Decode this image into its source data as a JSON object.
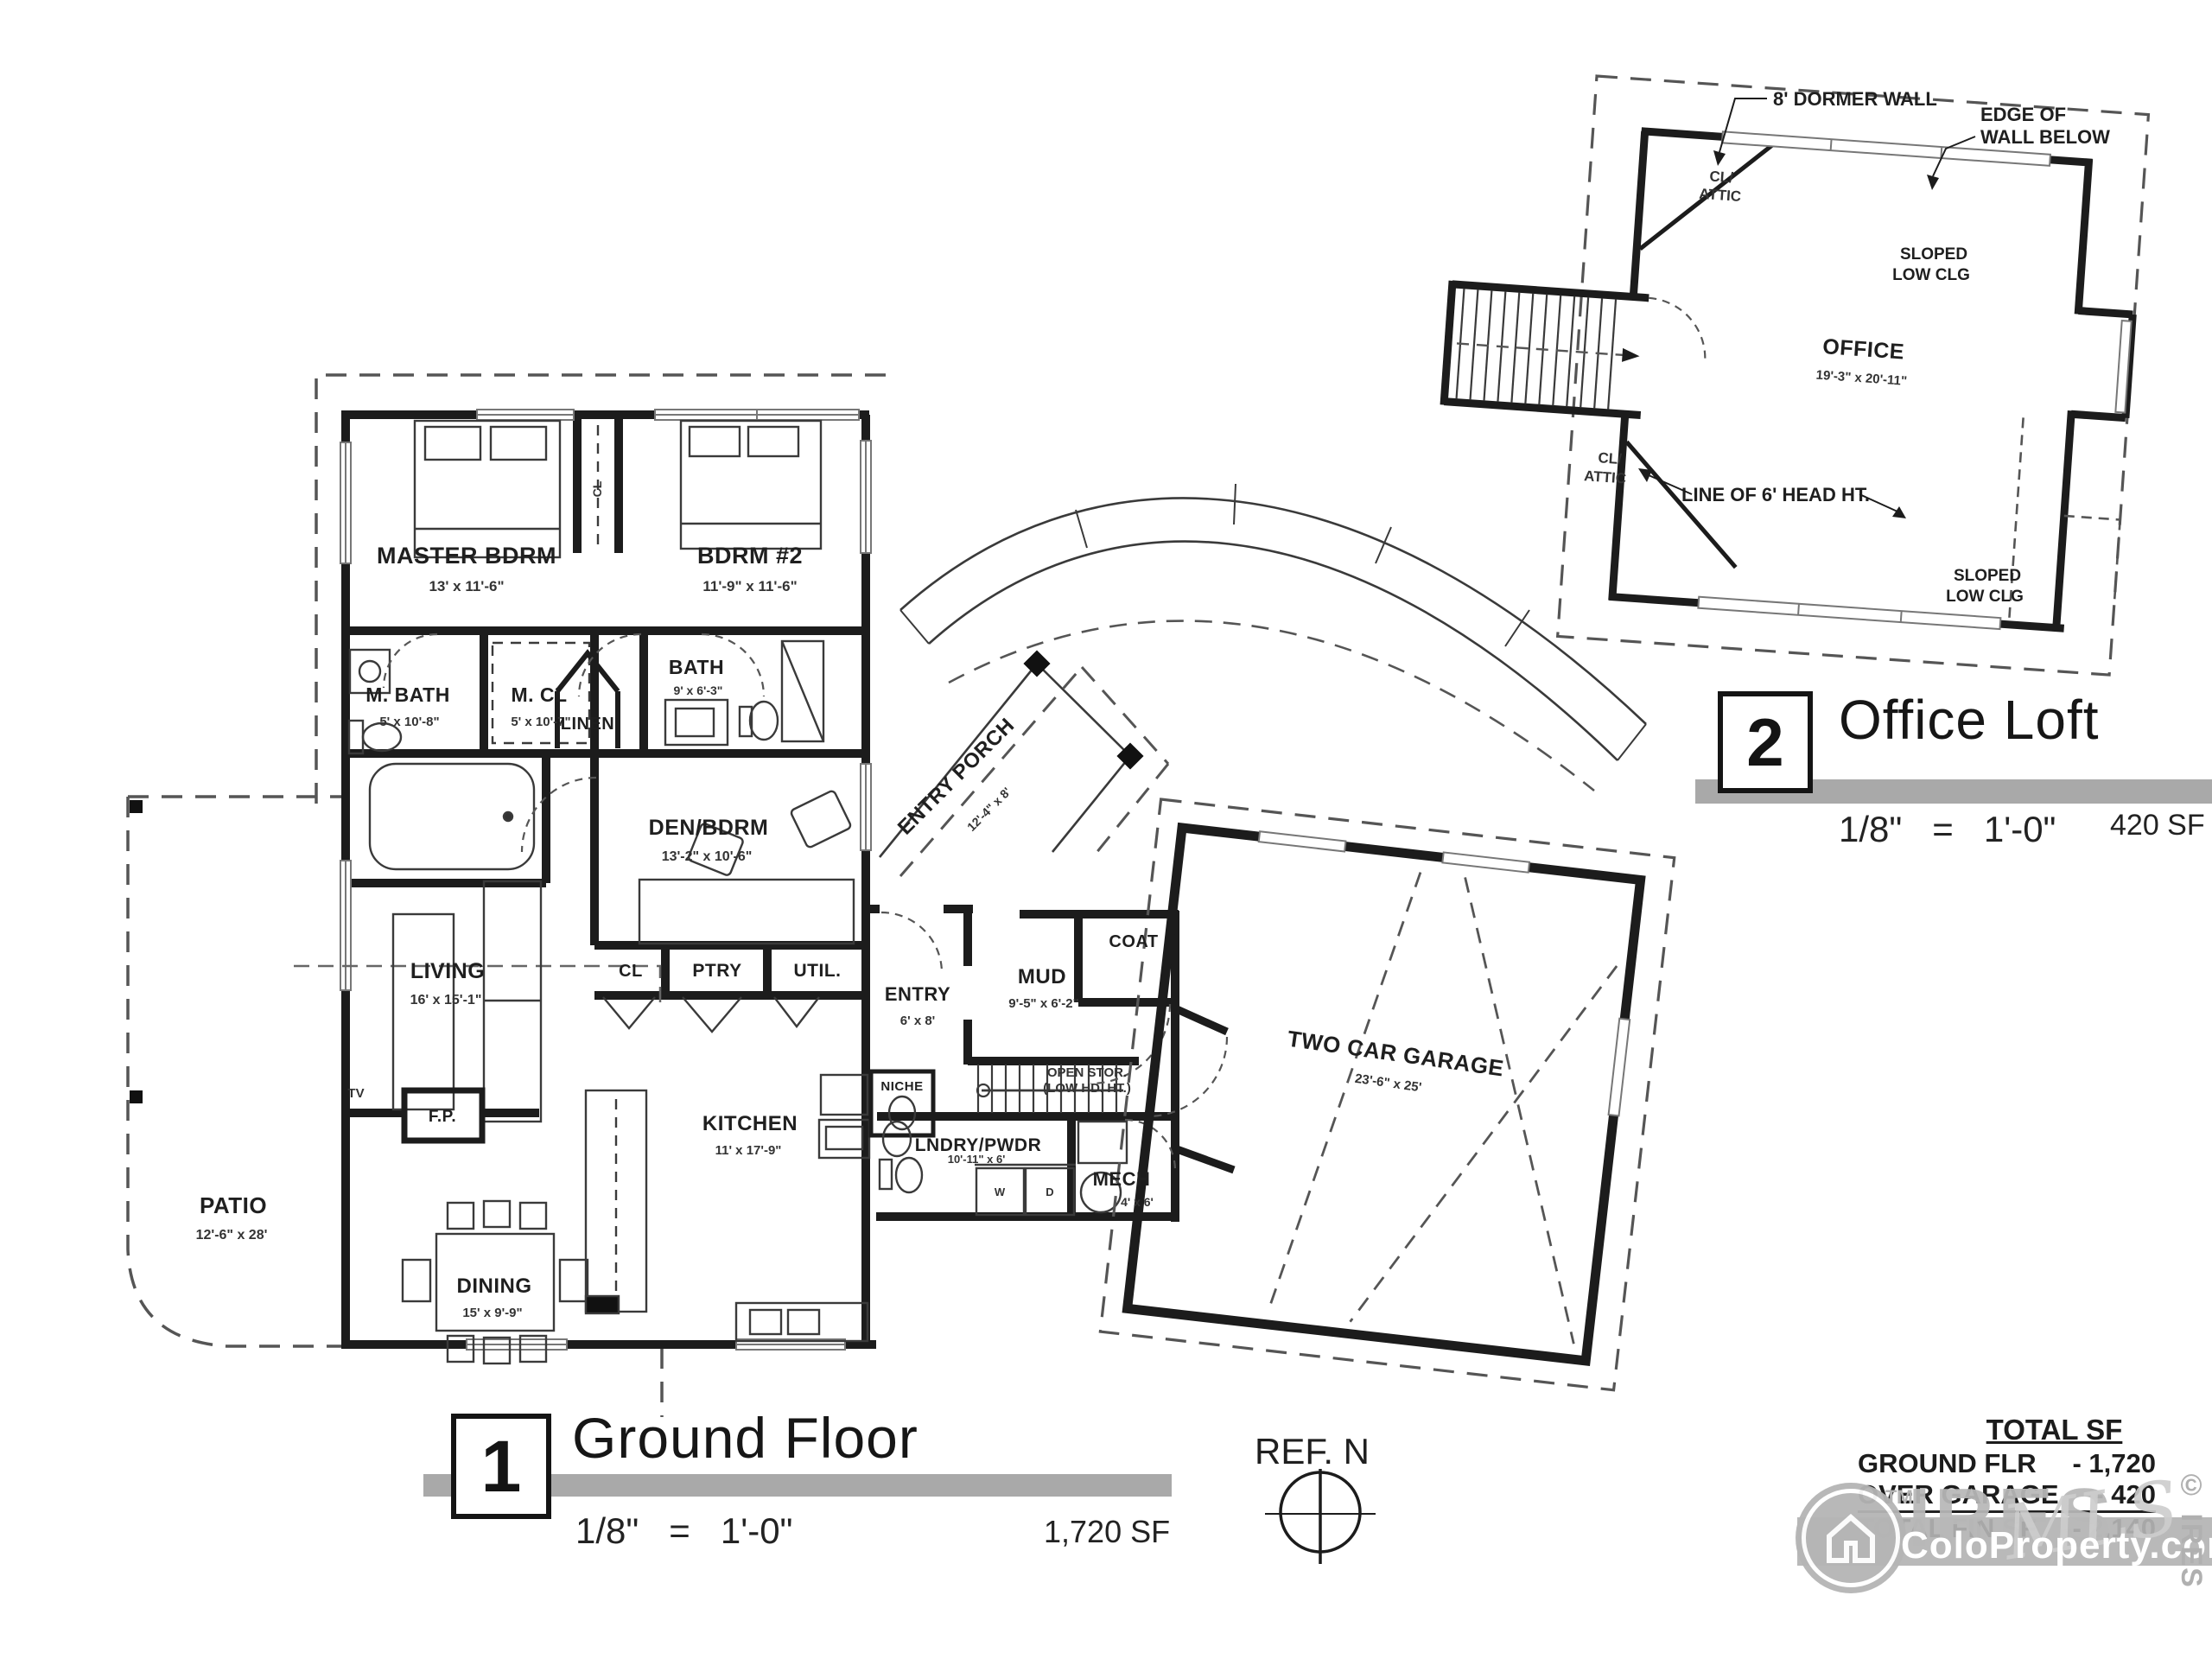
{
  "ground": {
    "master": {
      "name": "MASTER BDRM",
      "dims": "13' x 11'-6\""
    },
    "bdrm2": {
      "name": "BDRM #2",
      "dims": "11'-9\" x 11'-6\""
    },
    "mbath": {
      "name": "M. BATH",
      "dims": "5' x 10'-8\""
    },
    "mcl": {
      "name": "M. CL",
      "dims": "5' x 10'-7\""
    },
    "bath": {
      "name": "BATH",
      "dims": "9' x 6'-3\""
    },
    "linen": {
      "name": "LINEN"
    },
    "cl_bdrm": {
      "name": "CL"
    },
    "den": {
      "name": "DEN/BDRM",
      "dims": "13'-2\" x 10'-6\""
    },
    "porch": {
      "name": "ENTRY PORCH",
      "dims": "12'-4\" x 8'"
    },
    "living": {
      "name": "LIVING",
      "dims": "16' x 15'-1\""
    },
    "cl": {
      "name": "CL"
    },
    "ptry": {
      "name": "PTRY"
    },
    "util": {
      "name": "UTIL."
    },
    "entry": {
      "name": "ENTRY",
      "dims": "6' x 8'"
    },
    "mud": {
      "name": "MUD",
      "dims": "9'-5\" x 6'-2\""
    },
    "coat": {
      "name": "COAT"
    },
    "open_stor": {
      "line1": "OPEN STOR.",
      "line2": "(LOW HD. HT.)"
    },
    "niche": {
      "name": "NICHE"
    },
    "kitchen": {
      "name": "KITCHEN",
      "dims": "11' x 17'-9\""
    },
    "lndry": {
      "name": "LNDRY/PWDR",
      "dims": "10'-11\" x 6'"
    },
    "w": "W",
    "d": "D",
    "mech": {
      "name": "MECH",
      "dims": "4' x 6'"
    },
    "dining": {
      "name": "DINING",
      "dims": "15' x 9'-9\""
    },
    "patio": {
      "name": "PATIO",
      "dims": "12'-6\" x 28'"
    },
    "fp": "F.P.",
    "tv": "TV",
    "garage": {
      "name": "TWO CAR GARAGE",
      "dims": "23'-6\" x 25'"
    }
  },
  "loft": {
    "office": {
      "name": "OFFICE",
      "dims": "19'-3\" x 20'-11\""
    },
    "cl_attic": {
      "line1": "CL/",
      "line2": "ATTIC"
    },
    "annotations": {
      "dormer": "8' DORMER WALL",
      "edge_line1": "EDGE OF",
      "edge_line2": "WALL BELOW",
      "sloped_line1": "SLOPED",
      "sloped_line2": "LOW CLG",
      "head_ht": "LINE OF 6' HEAD HT."
    }
  },
  "plan1": {
    "number": "1",
    "title": "Ground Floor",
    "scale": "1/8\"   =   1'-0\"",
    "area": "1,720 SF"
  },
  "plan2": {
    "number": "2",
    "title": "Office Loft",
    "scale": "1/8\"   =   1'-0\"",
    "area": "420 SF"
  },
  "compass": {
    "label": "REF. N"
  },
  "totals": {
    "heading": "TOTAL SF",
    "rows": [
      {
        "label": "GROUND FLR",
        "value": "-  1,720"
      },
      {
        "label": "OVER GARAGE",
        "value": "-    420"
      },
      {
        "label": "TOTAL FIN SF",
        "value": "-  2,140"
      }
    ]
  },
  "watermark": {
    "brand": "IRES",
    "tm": "TM",
    "script": "MLS",
    "site": "ColoProperty.com®",
    "copyright": "© IRES",
    "gray": "#b3b3b3"
  },
  "colors": {
    "wall": "#1c1c1c",
    "thin": "#3a3a3a",
    "dashed": "#555555",
    "bar": "#a9a9a9"
  }
}
